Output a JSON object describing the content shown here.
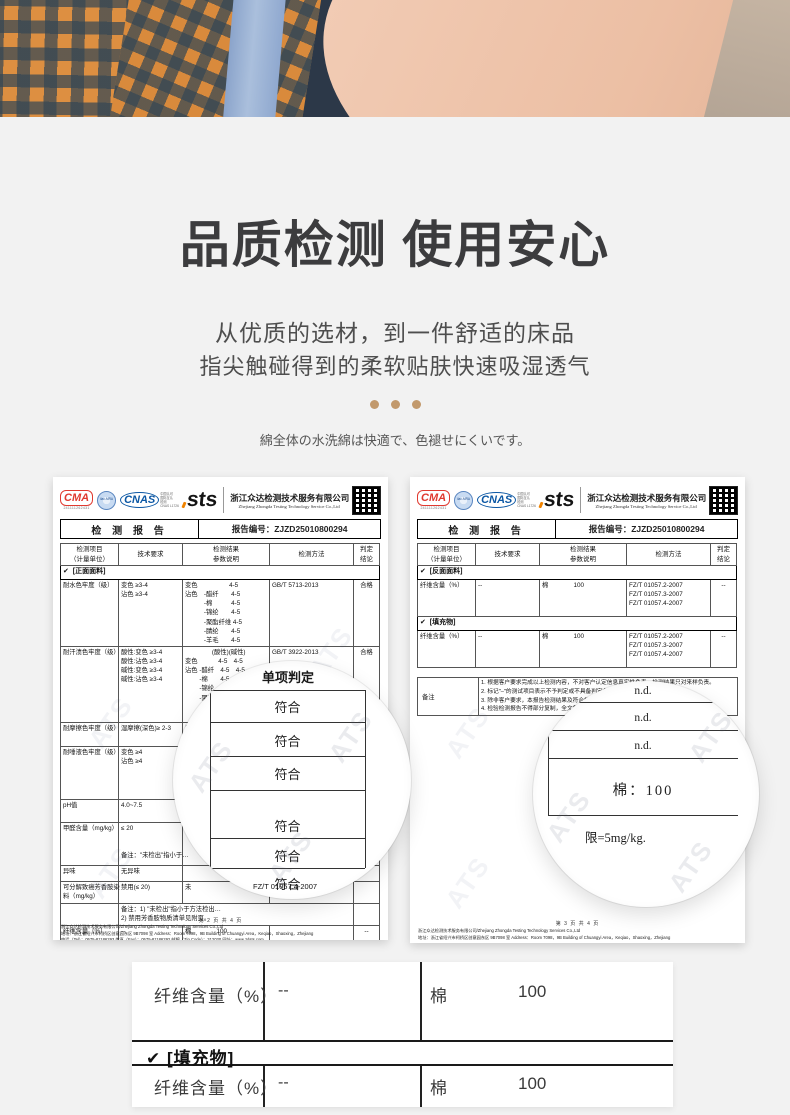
{
  "colors": {
    "dot-accent": "#c2996c",
    "seal-red": "#e03a30",
    "logo-blue": "#0b57a4",
    "page-bg": "#f2f2f2",
    "title": "#3c3c3e"
  },
  "intro": {
    "title": "品质检测 使用安心",
    "subtitle_line1": "从优质的选材，到一件舒适的床品",
    "subtitle_line2": "指尖触碰得到的柔软贴肤快速吸湿透气",
    "note_jp": "綿全体の水洗綿は快適で、色褪せにくいです。"
  },
  "report_common": {
    "logo_cma": "CMA",
    "logo_cma_number": "241111262431",
    "logo_ilac": "ilac-MRA",
    "logo_cnas": "CNAS",
    "logo_cnas_side": [
      "中国认可",
      "国际互认",
      "检测",
      "CNAS L1726"
    ],
    "logo_sts": "sts",
    "company_cn": "浙江众达检测技术服务有限公司",
    "company_en": "Zhejiang Zhongda Testing Technology Service Co.,Ltd",
    "report_title": "检 测 报 告",
    "report_no": "报告编号：ZJZD25010800294",
    "watermark": "ATS",
    "table_headers": [
      "检测项目\n（计量单位）",
      "技术要求",
      "检测结果\n参数说明",
      "检测方法",
      "判定\n结论"
    ],
    "footer_company": "浙江众达检测技术服务有限公司/Zhejiang Zhongda Testing Technology Services Co.,Ltd",
    "footer_address": "地址：浙江省绍兴市柯桥区创意园东区 9B7098 室      Address：Room 7098，9B Building of Chuangyi Area，Keqiao，Shaoxing，Zhejiang",
    "footer_contact": "电话（Tel）：0575-81186293        传真（Fax）：0575-81186292        邮编（Zip Code）：312030        网址：www.zdsts.com"
  },
  "left_report": {
    "page_footer": "第 2 页 共 4 页",
    "table": {
      "rows": [
        {
          "k": "section-front",
          "label": "[正面面料]"
        },
        {
          "k": "water",
          "item_lines": [
            "耐水色牢度（级）"
          ],
          "req_lines": [
            "变色 ≥3-4",
            "沾色 ≥3-4"
          ],
          "res_lines": [
            "变色　　　　　4-5",
            "沾色　-醋纤　　4-5",
            "　　　-棉　　　4-5",
            "　　　-锦纶　　4-5",
            "　　　-聚酯纤维 4-5",
            "　　　-腈纶　　4-5",
            "　　　-羊毛　　4-5"
          ],
          "method_lines": [
            "GB/T 5713-2013"
          ],
          "verdict": "合格"
        },
        {
          "k": "sweat",
          "item_lines": [
            "耐汗渍色牢度（级）"
          ],
          "req_lines": [
            "酸性:变色 ≥3-4",
            "酸性:沾色 ≥3-4",
            "碱性:变色 ≥3-4",
            "碱性:沾色 ≥3-4"
          ],
          "res_lines": [
            "　　　　 (酸性)(碱性)",
            "变色　　　 4-5　4-5",
            "沾色 -醋纤　4-5　4-5",
            "　　 -棉　　4-5　4-5",
            "　　 -锦纶　4-5　4-5",
            "　　 -聚酯纤维 4-5 4-5",
            "　　 -腈纶　4-5",
            "　　 -羊毛"
          ],
          "method_lines": [
            "GB/T 3922-2013"
          ],
          "verdict": "合格"
        },
        {
          "k": "rub",
          "item_lines": [
            "耐摩擦色牢度（级）"
          ],
          "req_lines": [
            "湿摩擦(深色)≥ 2-3"
          ],
          "res_lines": [
            "湿摩擦"
          ],
          "method_lines": [],
          "verdict": "合格"
        },
        {
          "k": "saliva",
          "item_lines": [
            "耐唾液色牢度（级）"
          ],
          "req_lines": [
            "变色 ≥4",
            "沾色 ≥4"
          ],
          "res_lines": [
            "变色",
            "沾色"
          ],
          "method_lines": [],
          "verdict": ""
        },
        {
          "k": "ph",
          "item_lines": [
            "pH值"
          ],
          "req_lines": [
            "4.0~7.5"
          ],
          "res_lines": [],
          "method_lines": [],
          "verdict": ""
        },
        {
          "k": "formaldehyde",
          "item_lines": [
            "甲醛含量（mg/kg）"
          ],
          "req_lines": [
            "≤ 20",
            "",
            "",
            "备注：\"未检出\"指小于…"
          ],
          "res_lines": [],
          "method_lines": [],
          "verdict": ""
        },
        {
          "k": "odor",
          "item_lines": [
            "异味"
          ],
          "req_lines": [
            "无异味"
          ],
          "res_lines": [],
          "method_lines": [],
          "verdict": ""
        },
        {
          "k": "amines",
          "item_lines": [
            "可分解致癌芳香胺染",
            "料（mg/kg）"
          ],
          "req_lines": [
            "禁用(≤ 20)"
          ],
          "res_lines": [
            "未"
          ],
          "method_lines": [],
          "verdict": ""
        },
        {
          "k": "note",
          "item_lines": [],
          "req_lines": [
            "备注：1) \"未检出\"指小于方法检出…",
            "2) 禁用芳香胺物质清单见附页。"
          ],
          "res_lines": [],
          "method_lines": [],
          "verdict": ""
        },
        {
          "k": "fiber",
          "item_lines": [
            "纤维含量（%）"
          ],
          "req_lines": [
            "--"
          ],
          "res_lines": [
            "棉　　　　100"
          ],
          "method_lines": [],
          "verdict": "--"
        }
      ]
    },
    "magnifier": {
      "header": "单项判定",
      "values": [
        "符合",
        "符合",
        "符合",
        "符合",
        "符合",
        "符合"
      ],
      "method_note": "FZ/T 01057.4-2007"
    }
  },
  "right_report": {
    "page_footer": "第 3 页 共 4 页",
    "table": {
      "rows": [
        {
          "k": "section-back",
          "label": "[反面面料]"
        },
        {
          "k": "fiber-back",
          "item_lines": [
            "纤维含量（%）"
          ],
          "req_lines": [
            "--"
          ],
          "res_lines": [
            "棉　　　　100"
          ],
          "method_lines": [
            "FZ/T 01057.2-2007",
            "FZ/T 01057.3-2007",
            "FZ/T 01057.4-2007"
          ],
          "verdict": "--"
        },
        {
          "k": "section-fill",
          "label": "[填充物]"
        },
        {
          "k": "fiber-fill",
          "item_lines": [
            "纤维含量（%）"
          ],
          "req_lines": [
            "--"
          ],
          "res_lines": [
            "棉　　　　100"
          ],
          "method_lines": [
            "FZ/T 01057.2-2007",
            "FZ/T 01057.3-2007",
            "FZ/T 01057.4-2007"
          ],
          "verdict": "--"
        }
      ]
    },
    "notes_label": "备注",
    "notes": [
      "1.  根据客户要求完成以上检测内容，不对客户认定信息真实性负责，检测结果只对来样负责。",
      "2.  标记\"–\"的测试项目表示不予判定或不具备判定条件。",
      "3.  除非客户要求，本报告检测结果及符合性判定不考虑测量结果的不确定度。",
      "4.  检验检测报告不得部分复制，全文复制除　　　　　　　　　　　　检测专用章\"无效。"
    ],
    "magnifier": {
      "values": [
        "n.d.",
        "n.d.",
        "n.d.",
        "棉：100"
      ],
      "limit_note": "限=5mg/kg."
    }
  },
  "zoom_card": {
    "row_top": {
      "item": "纤维含量（%）",
      "req": "--",
      "res_name": "棉",
      "res_value": "100"
    },
    "section_label": "✔  [填充物]",
    "row_bottom": {
      "item": "纤维含量（%）",
      "req": "--",
      "res_name": "棉",
      "res_value": "100"
    }
  }
}
